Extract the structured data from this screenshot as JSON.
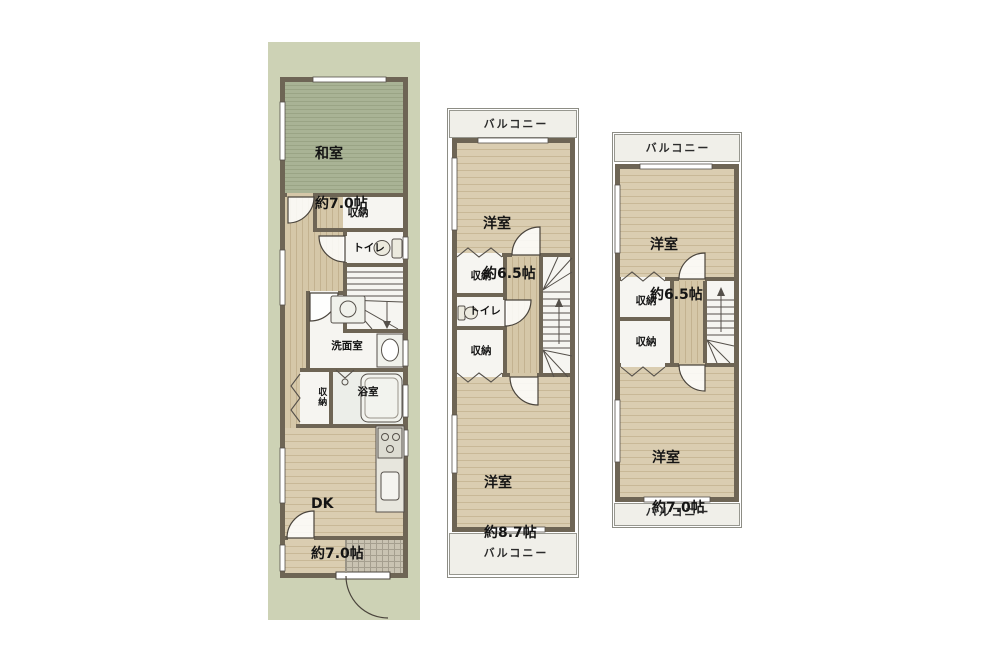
{
  "palette": {
    "lot_green": "#cdd2b5",
    "wall": "#6e6555",
    "tatami_green": "#a9b395",
    "wood_beige": "#dacdb1",
    "balcony_bg": "#f0efe9",
    "tile_gray": "#c9c3b2"
  },
  "floor1": {
    "rooms": {
      "washitsu": {
        "name": "和室",
        "size": "約7.0帖"
      },
      "closet_top": "収納",
      "toilet": "トイレ",
      "washroom": "洗面室",
      "closet_small": "収納",
      "bath": "浴室",
      "dk": {
        "name": "DK",
        "size": "約7.0帖"
      }
    }
  },
  "floor2": {
    "balcony_top": "バルコニー",
    "balcony_bottom": "バルコニー",
    "rooms": {
      "bedroom_top": {
        "name": "洋室",
        "size": "約6.5帖"
      },
      "closet_a": "収納",
      "toilet": "トイレ",
      "closet_b": "収納",
      "bedroom_bottom": {
        "name": "洋室",
        "size": "約8.7帖"
      }
    }
  },
  "floor3": {
    "balcony_top": "バルコニー",
    "balcony_bottom": "バルコニー",
    "rooms": {
      "bedroom_top": {
        "name": "洋室",
        "size": "約6.5帖"
      },
      "closet_a": "収納",
      "closet_b": "収納",
      "bedroom_bottom": {
        "name": "洋室",
        "size": "約7.0帖"
      }
    }
  }
}
